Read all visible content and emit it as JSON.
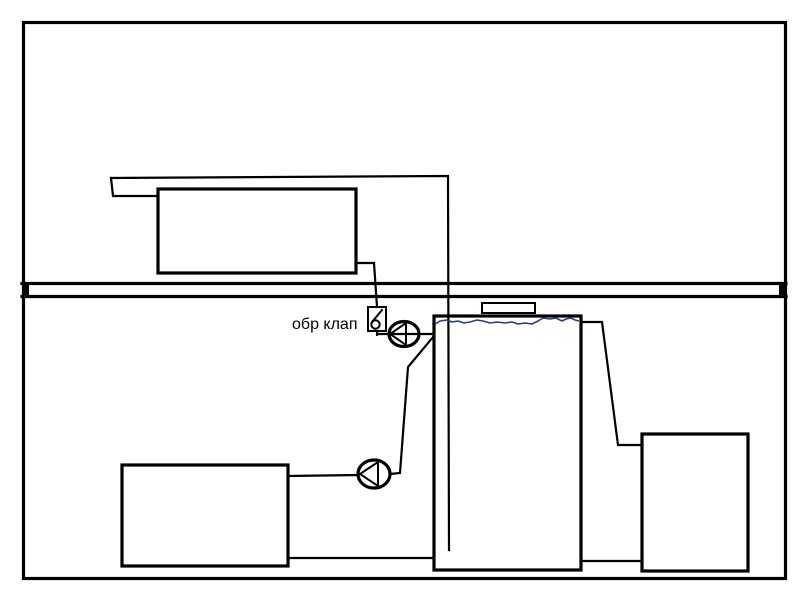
{
  "labels": {
    "check_valve": "обр клап"
  },
  "colors": {
    "line": "#000000",
    "water": "#2b3a8f",
    "background": "#ffffff"
  },
  "components": {
    "upper_box": "upper-floor tank",
    "main_tank": "open water tank with water level",
    "lower_left_box": "lower-left unit",
    "right_box": "right unit",
    "pump_upper": "circulation pump (upper)",
    "pump_lower": "circulation pump (lower)",
    "check_valve": "check valve",
    "floor_divider": "floor / ceiling slab"
  }
}
